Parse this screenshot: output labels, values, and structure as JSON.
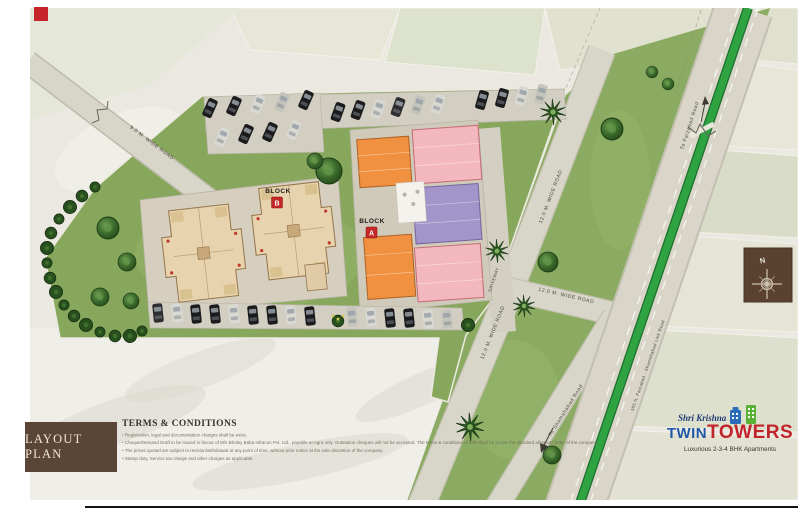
{
  "plan": {
    "blocks": {
      "b_label": "BLOCK",
      "b_letter": "B",
      "a_label": "BLOCK",
      "a_letter": "A"
    },
    "roads": {
      "r9m": "9.0 M. WIDE ROAD",
      "r12m_upper": "12.0 M. WIDE ROAD",
      "r12m_mid": "12.0 M. WIDE ROAD",
      "r12m_lower": "12.0 M. WIDE ROAD",
      "driveway": "DRIVEWAY",
      "to_shamshabad": "To Shamshabad Road",
      "to_faizabad": "To Faizabad Road",
      "link_road": "105 ft. Faizabad - Shamshabad Link Road"
    },
    "compass": {
      "north": "N"
    }
  },
  "footer": {
    "layout_plan_title": "LAYOUT PLAN",
    "terms_heading": "TERMS & CONDITIONS",
    "terms_items": [
      "Registration, legal and documentation charges shall be extra.",
      "Cheque/Demand Draft to be issued in favour of M/s Bholey Baba Infracon Pvt. Ltd., payable at Agra only. Outstation cheques will not be accepted. The terms & conditions of sale shall be as per the standard allotment letter of the company.",
      "The prices quoted are subject to revision/withdrawal at any point of time, without prior notice at the sole discretion of the company.",
      "Stamp duty, Service tax charge and other charges as applicable."
    ]
  },
  "logo": {
    "brand_script": "Shri Krishna",
    "brand_twin": "TWIN",
    "brand_towers": "TOWERS",
    "tagline": "Luxurious 2-3-4 BHK Apartments"
  },
  "colors": {
    "accent_red": "#c4242a",
    "logo_blue": "#2059a8",
    "logo_red": "#c2242b",
    "site_green": "#87a75c",
    "road_gray": "#d8d5c9",
    "median_green": "#2fa341",
    "block_b_beige": "#e7d3ad",
    "block_a_orange": "#ef9140",
    "block_a_pink": "#f3b8be",
    "block_a_purple": "#a195ca",
    "panel_brown": "#5a4536",
    "compass_brown": "#5a4130"
  }
}
